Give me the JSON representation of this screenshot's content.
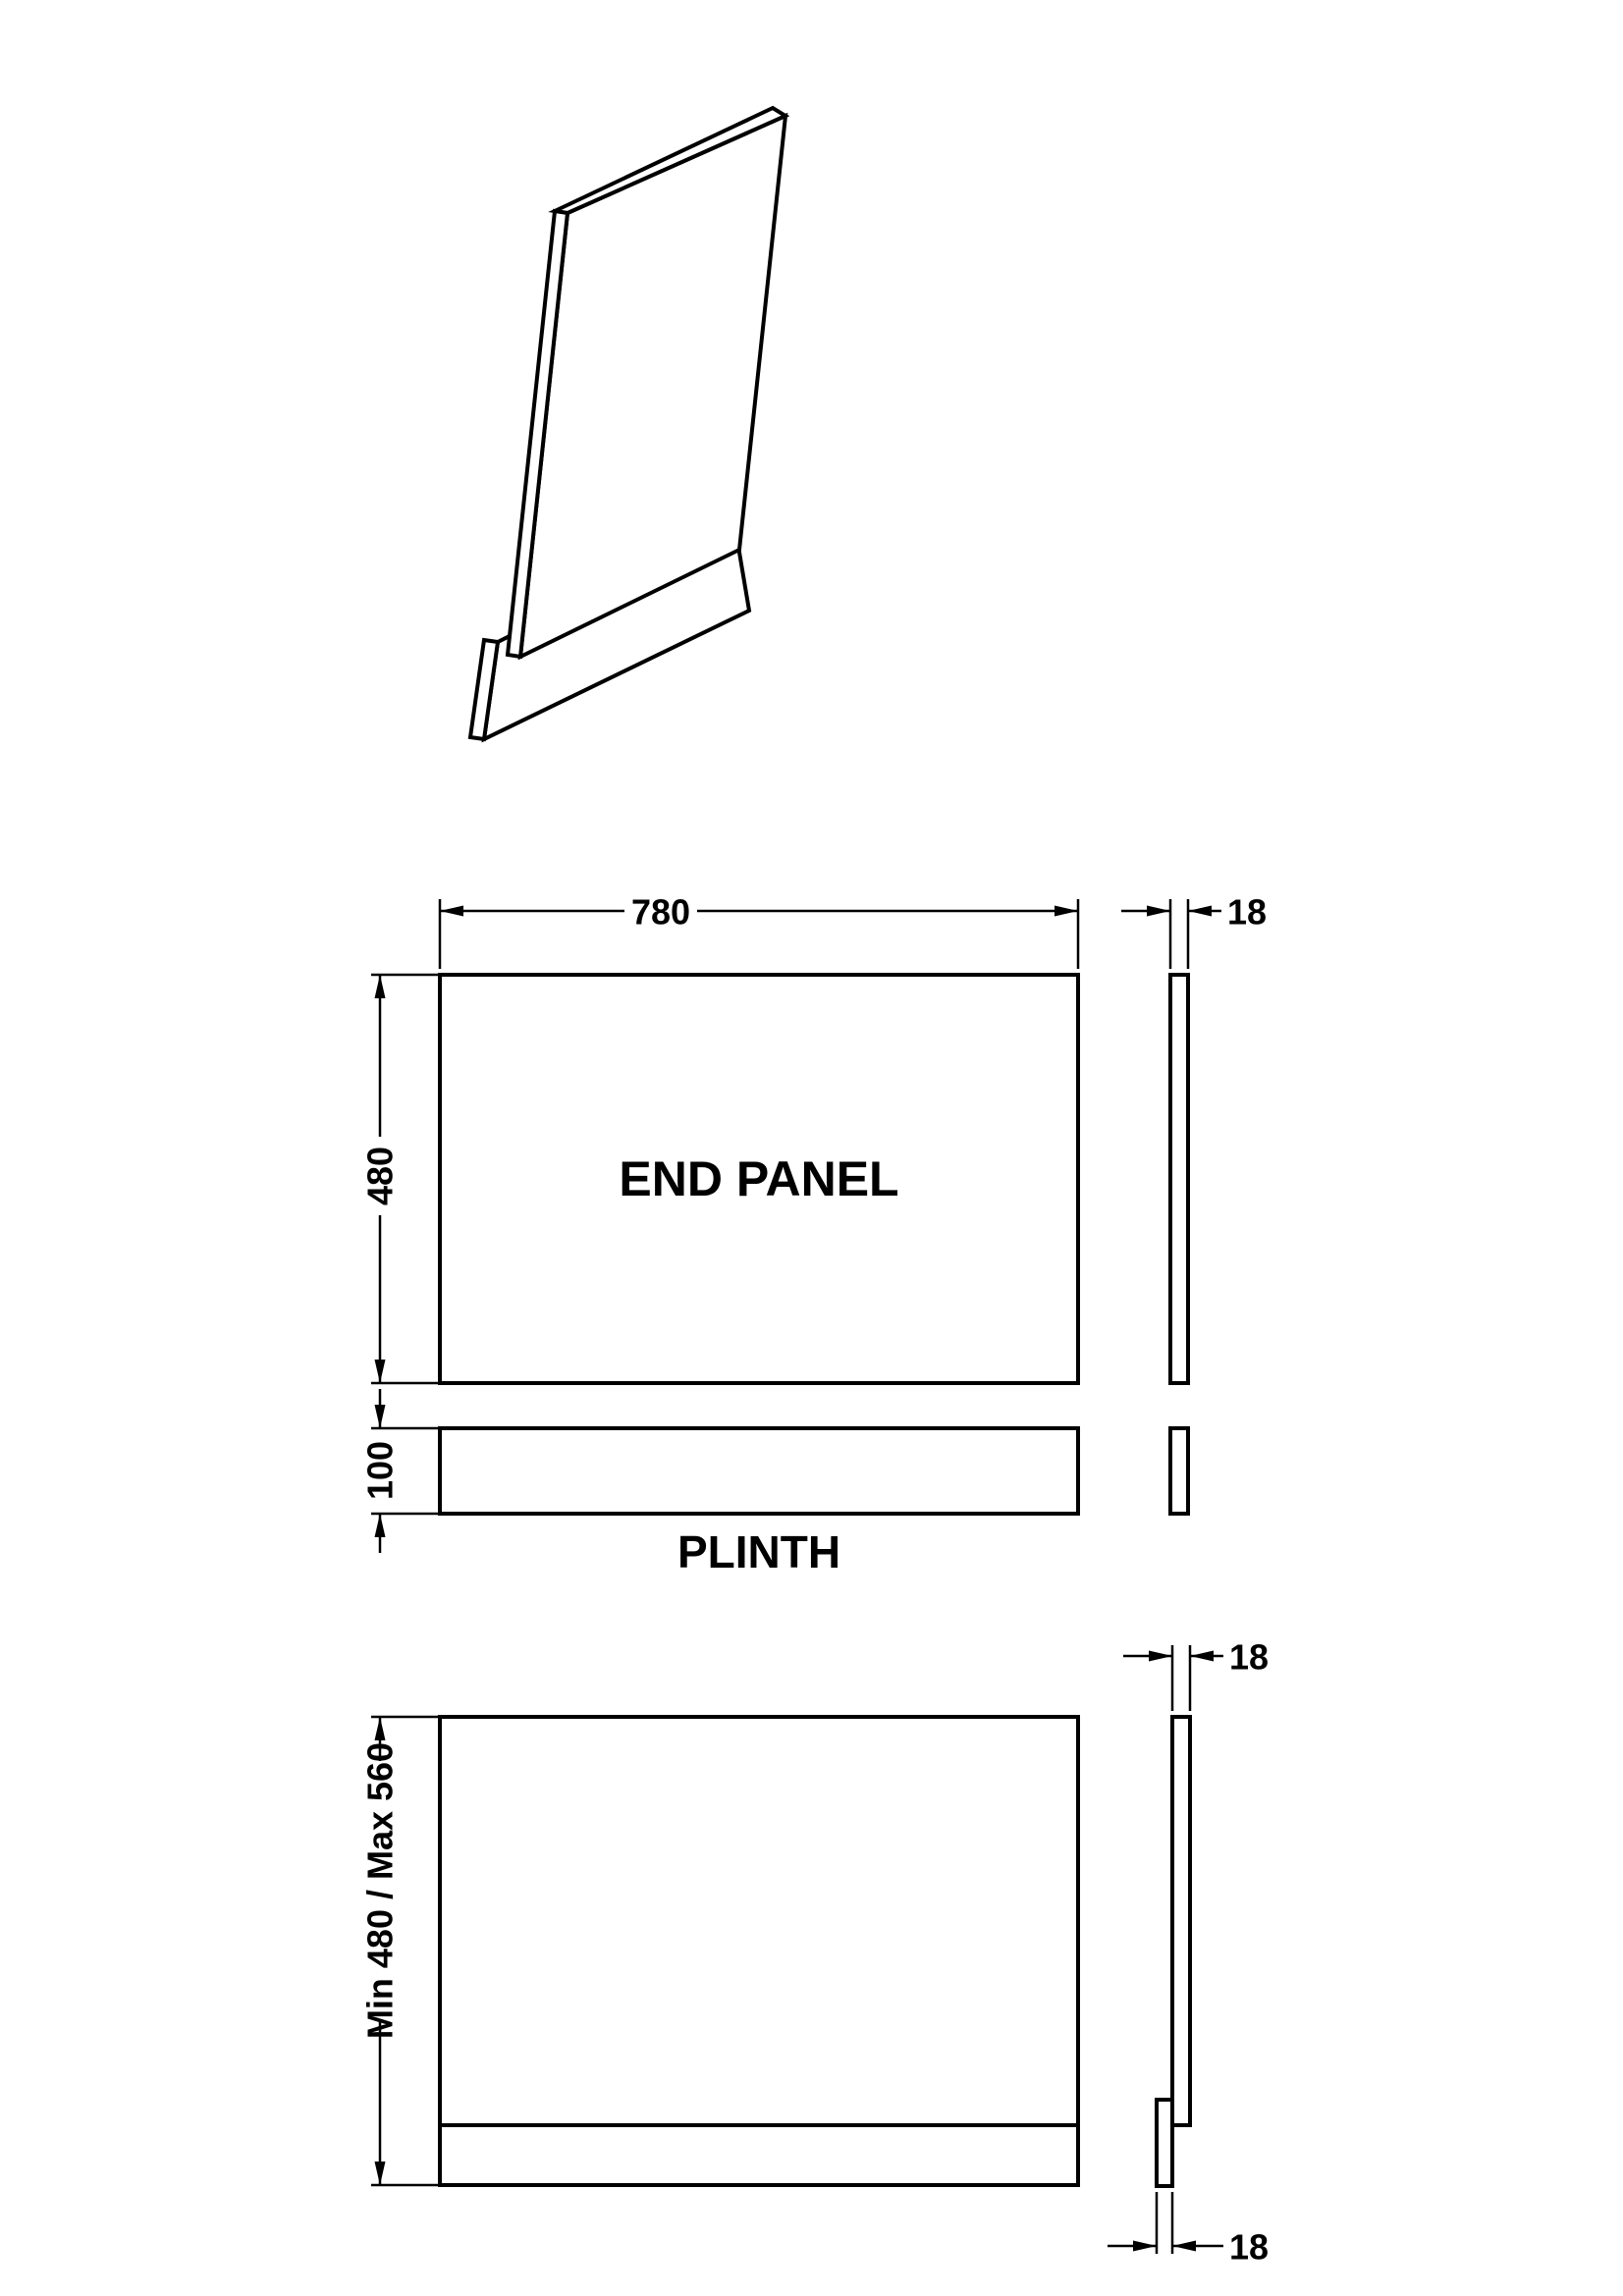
{
  "style": {
    "background": "#ffffff",
    "line_color": "#000000",
    "text_color": "#000000"
  },
  "views": {
    "end_panel": {
      "label": "END PANEL",
      "width_dim": "780",
      "height_dim": "480",
      "thickness_dim": "18"
    },
    "plinth": {
      "label": "PLINTH",
      "height_dim": "100"
    },
    "assembled": {
      "height_dim": "Min 480 / Max 560",
      "top_thickness_dim": "18",
      "bottom_thickness_dim": "18"
    }
  }
}
